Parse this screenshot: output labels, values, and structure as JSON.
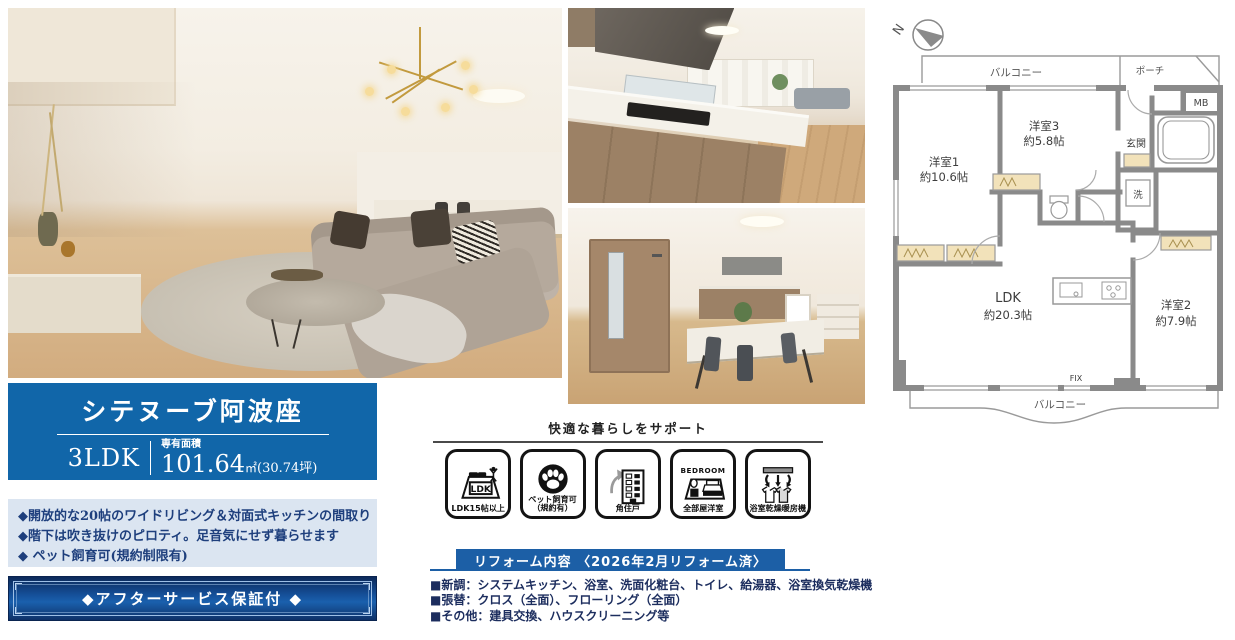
{
  "property": {
    "name": "シテヌーブ阿波座",
    "plan_type": "3LDK",
    "area_label": "専有面積",
    "area_value": "101.64",
    "area_unit": "㎡",
    "area_tsubo": "(30.74坪)",
    "features": [
      "◆開放的な20帖のワイドリビング＆対面式キッチンの間取り",
      "◆階下は吹き抜けのピロティ。足音気にせず暮らせます",
      "◆ ペット飼育可(規約制限有)"
    ],
    "after_service_label": "◆アフターサービス保証付 ◆"
  },
  "support": {
    "heading": "快適な暮らしをサポート",
    "badges": [
      {
        "icon": "ldk-room-icon",
        "glyph_text": "LDK",
        "label": "LDK15帖以上"
      },
      {
        "icon": "pet-paw-icon",
        "label": "ペット飼育可",
        "sublabel": "（規約有）"
      },
      {
        "icon": "corner-building-icon",
        "label": "角住戸"
      },
      {
        "icon": "bedroom-bed-icon",
        "glyph_text": "BEDROOM",
        "label": "全部屋洋室"
      },
      {
        "icon": "bath-dryer-icon",
        "label": "浴室乾燥暖房機"
      }
    ]
  },
  "reform": {
    "heading": "リフォーム内容 〈2026年2月リフォーム済〉",
    "items": [
      "■新調：システムキッチン、浴室、洗面化粧台、トイレ、給湯器、浴室換気乾燥機",
      "■張替：クロス（全面）、フローリング（全面）",
      "■その他：建具交換、ハウスクリーニング等"
    ]
  },
  "floorplan": {
    "compass_label": "N",
    "labels": {
      "balcony_top": "バルコニー",
      "porch": "ポーチ",
      "mb": "MB",
      "genkan": "玄関",
      "laundry": "洗",
      "room1_name": "洋室1",
      "room1_size": "約10.6帖",
      "room3_name": "洋室3",
      "room3_size": "約5.8帖",
      "ldk_name": "LDK",
      "ldk_size": "約20.3帖",
      "room2_name": "洋室2",
      "room2_size": "約7.9帖",
      "fix": "FIX",
      "balcony_bottom": "バルコニー"
    }
  },
  "colors": {
    "banner_blue": "#1166a9",
    "panel_light_blue": "#dbe5f1",
    "text_navy": "#1e3f7d",
    "button_gradient_dark": "#0c2a5a",
    "button_gradient_light": "#1a60ad",
    "reform_banner_blue": "#1c5fa6",
    "floorplan_wall_gray": "#8a8a8a",
    "closet_beige": "#f2e2ba"
  }
}
